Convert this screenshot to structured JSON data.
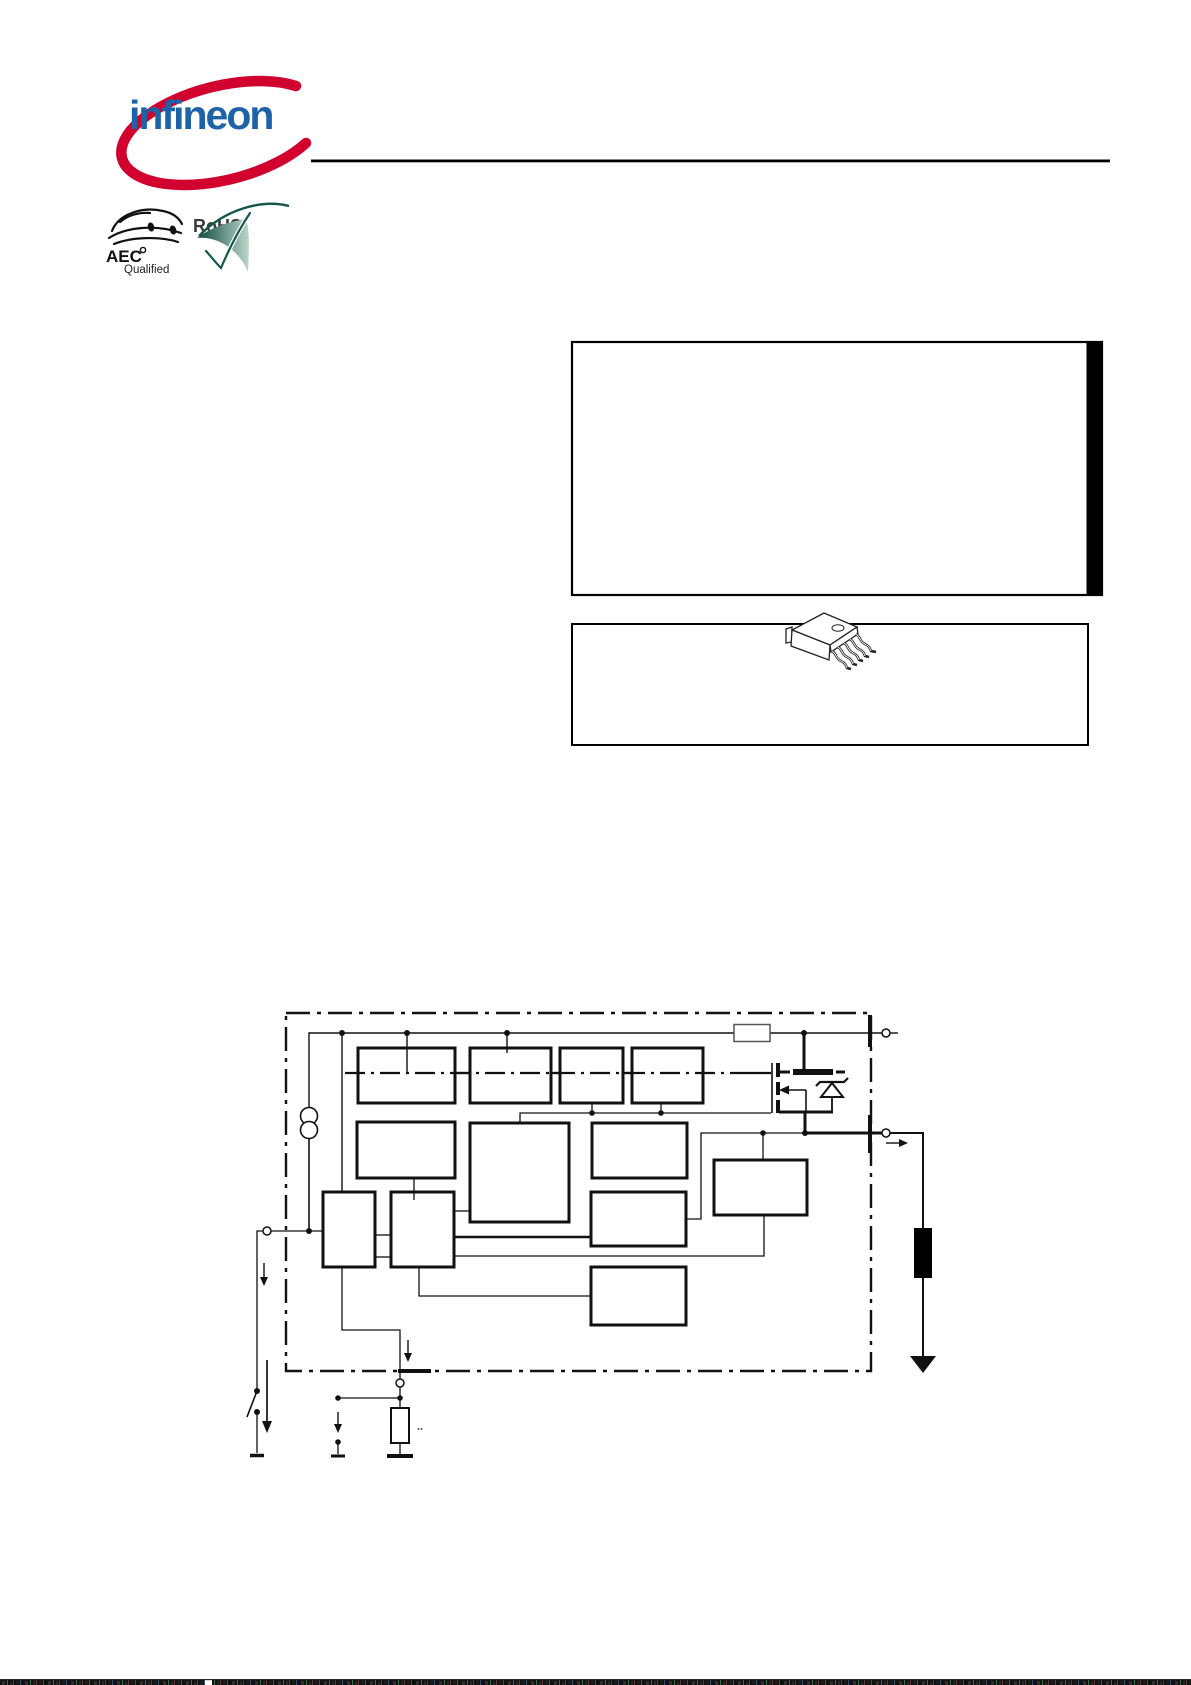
{
  "header": {
    "brand_text": "infineon"
  },
  "badges": {
    "aec_line1": "AEC",
    "aec_line2": "Qualified",
    "rohs_label": "RoHS"
  },
  "colors": {
    "infineon_red": "#D2002E",
    "infineon_blue": "#1E63A8",
    "rohs_dark": "#14584A",
    "rohs_light": "#BCD6CA",
    "line_black": "#111111"
  },
  "icons": [
    "infineon-logo",
    "aec-qualified-badge",
    "rohs-badge",
    "d2pak-package-icon",
    "current-source-icon",
    "mosfet-icon",
    "zener-diode-icon",
    "series-resistor-icon",
    "load-resistor-icon",
    "pulldown-resistor-icon",
    "ground-icon",
    "switch-icon",
    "current-arrow-icon",
    "input-terminal-icon",
    "output-terminal-icon",
    "ground-terminal-icon"
  ],
  "figure": {
    "feature_box": "empty framed panel with black side bar",
    "package_box": "framed panel with package drawing",
    "block_diagram": "IC block diagram with dash-dot chip boundary, 11 unlabeled function blocks, output MOSFET with zener, external load and sense resistor"
  }
}
